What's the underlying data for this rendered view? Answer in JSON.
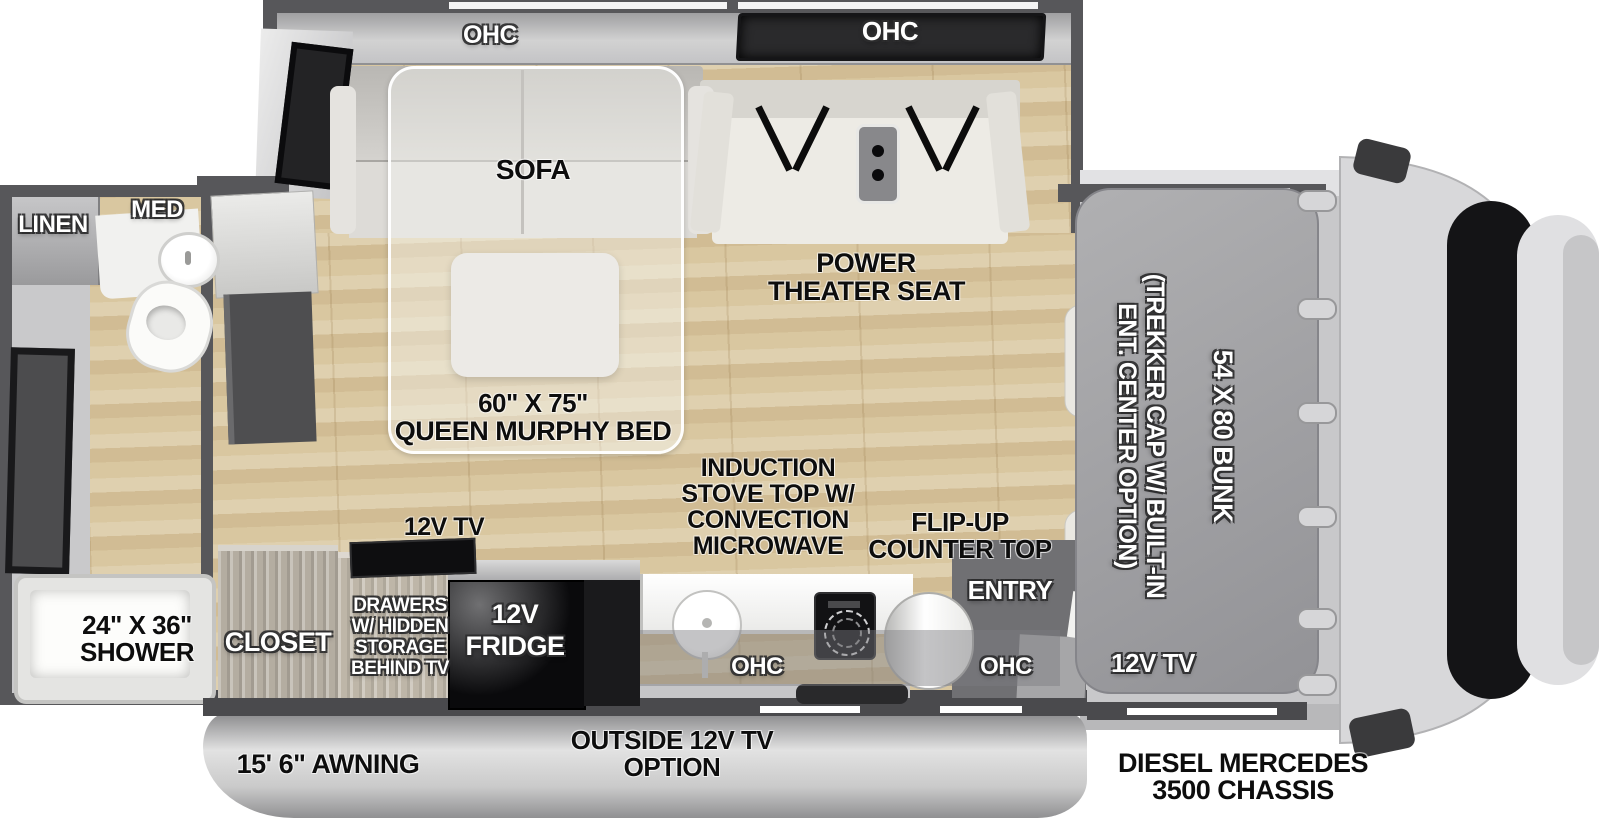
{
  "title": "Class C motorhome floorplan",
  "slideout": {
    "ohc_left": "OHC",
    "ohc_right": "OHC",
    "sofa": "SOFA",
    "theater": [
      "POWER",
      "THEATER SEAT"
    ]
  },
  "murphy": {
    "size": "60\" X 75\"",
    "name": "QUEEN MURPHY BED"
  },
  "bath": {
    "linen": "LINEN",
    "med": "MED",
    "shower": [
      "24\" X 36\"",
      "SHOWER"
    ]
  },
  "kitchen": {
    "tv": "12V TV",
    "closet": "CLOSET",
    "drawers": [
      "DRAWERS",
      "W/ HIDDEN",
      "STORAGE",
      "BEHIND TV"
    ],
    "fridge": [
      "12V",
      "FRIDGE"
    ],
    "induction": [
      "INDUCTION",
      "STOVE TOP W/",
      "CONVECTION",
      "MICROWAVE"
    ],
    "flip_up": [
      "FLIP-UP",
      "COUNTER TOP"
    ],
    "entry": "ENTRY",
    "ohc_sink": "OHC",
    "ohc_entry": "OHC"
  },
  "bunk": {
    "option": [
      "(TREKKER CAP W/ BUILT-IN",
      "ENT. CENTER OPTION)"
    ],
    "size": "54 X 80 BUNK",
    "tv": "12V TV"
  },
  "exterior": {
    "awning": "15' 6\" AWNING",
    "outside_tv": [
      "OUTSIDE 12V TV",
      "OPTION"
    ],
    "chassis": [
      "DIESEL MERCEDES",
      "3500 CHASSIS"
    ]
  },
  "colors": {
    "wall": "#57575a",
    "floor_wood": "#d9c7a0",
    "bunk_overlay": "#a2a2a6",
    "dark_cabinet": "#2a2a2c"
  }
}
